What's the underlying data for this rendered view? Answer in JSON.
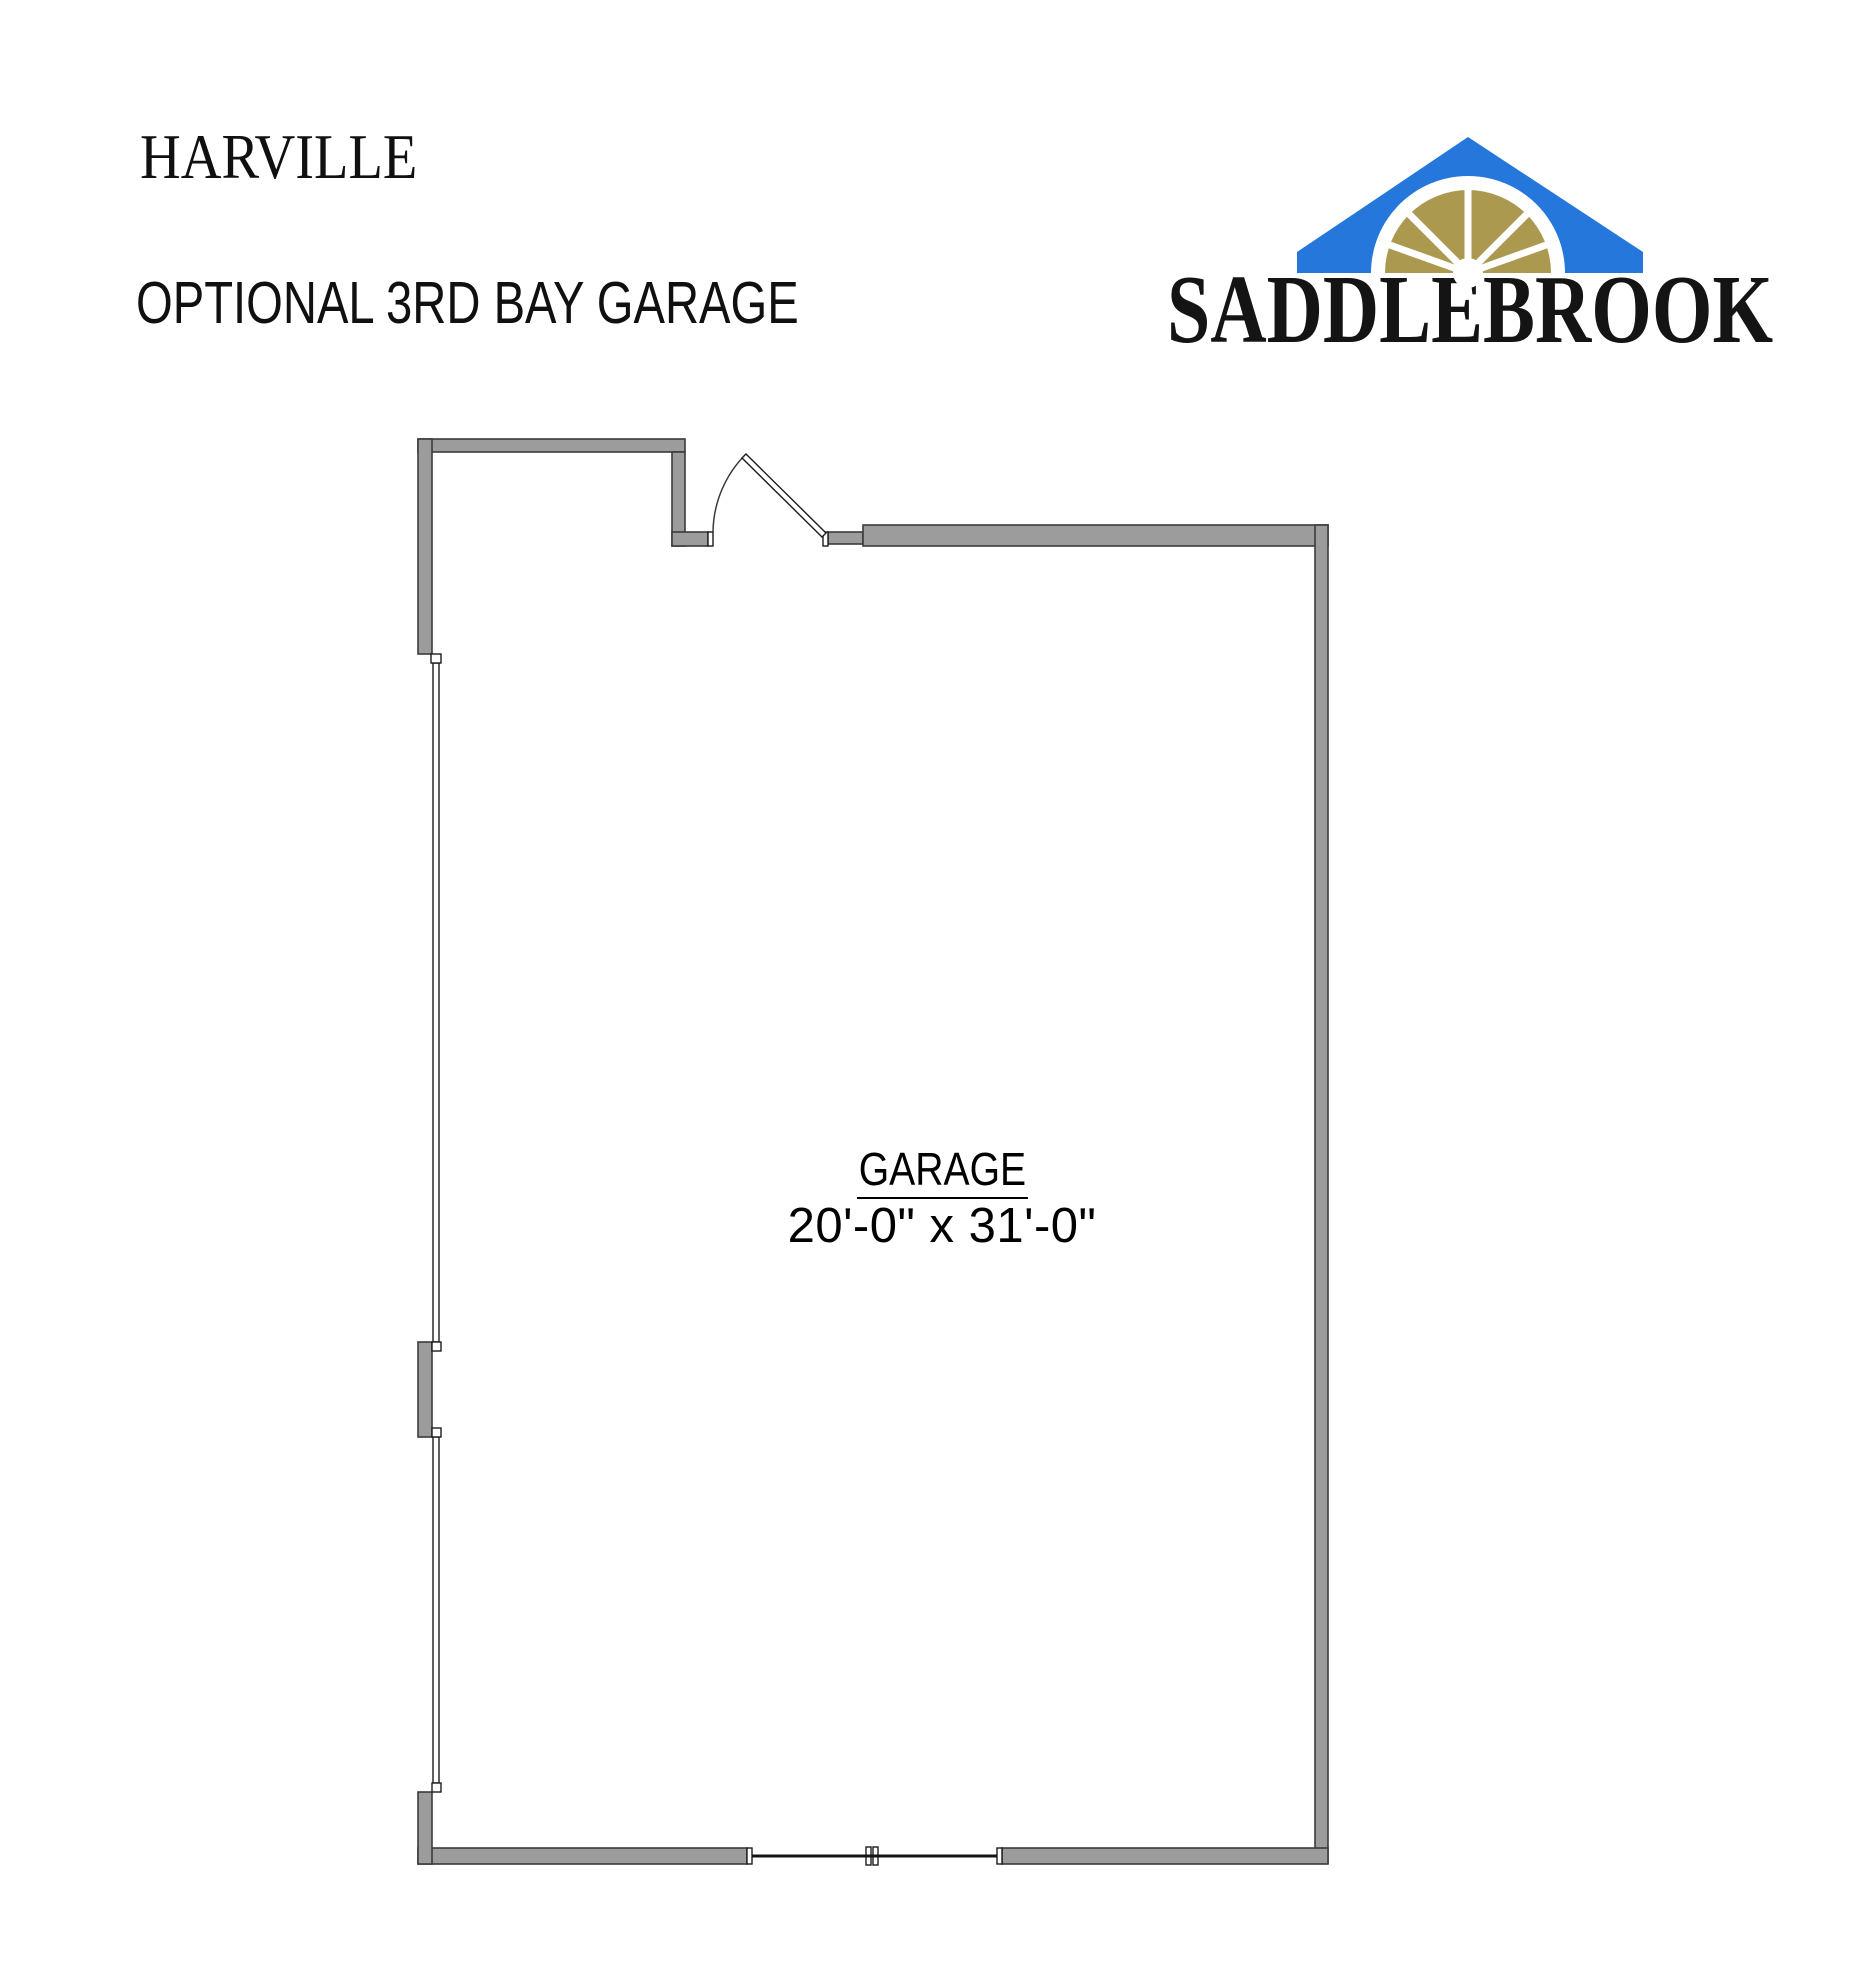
{
  "page": {
    "background": "#FFFFFF"
  },
  "header": {
    "plan_name": "HARVILLE",
    "option_title": "OPTIONAL 3RD BAY GARAGE"
  },
  "logo": {
    "wordmark": "SADDLEBROOK",
    "colors": {
      "roof_blue": "#2577DB",
      "fan_gold": "#AC9950"
    }
  },
  "floor_plan": {
    "room": {
      "label": "GARAGE",
      "dimensions": "20'-0\" x 31'-0\""
    },
    "colors": {
      "wall_fill": "#9C9C9C"
    }
  }
}
